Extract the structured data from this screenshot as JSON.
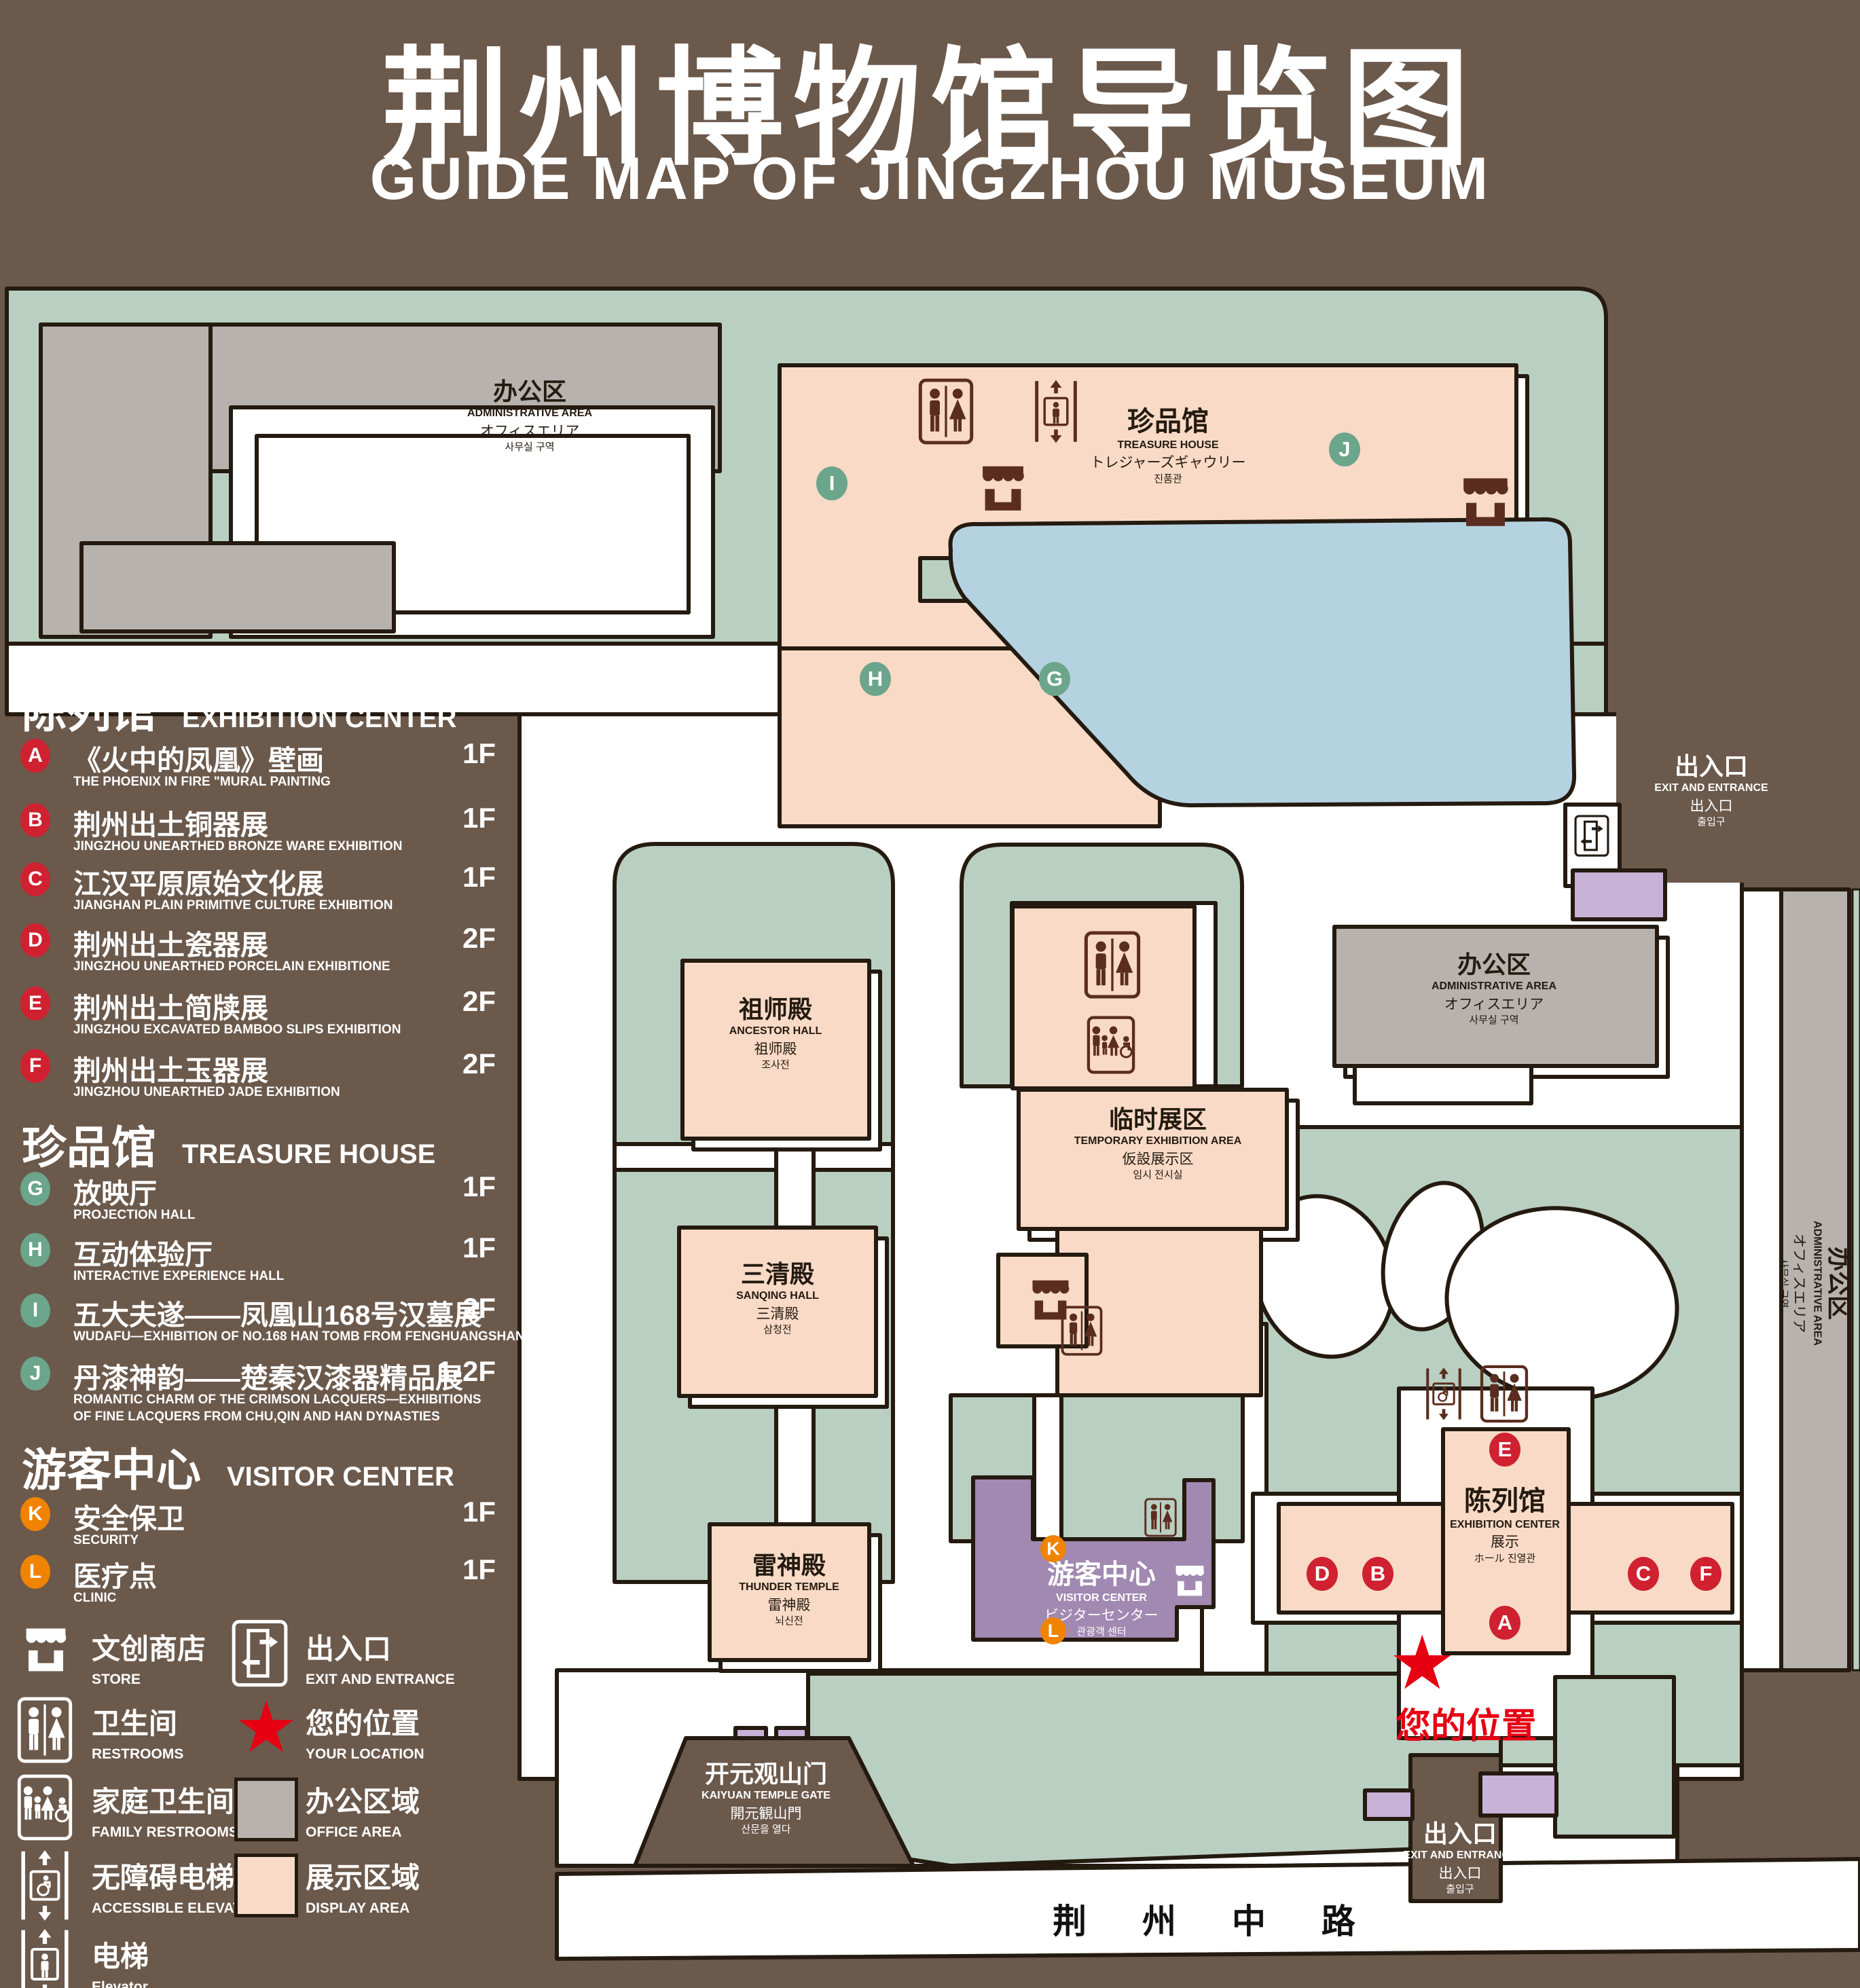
{
  "title": {
    "zh": "荆州博物馆导览图",
    "en": "GUIDE MAP OF JINGZHOU MUSEUM"
  },
  "legend": {
    "sections": [
      {
        "zh": "陈列馆",
        "en": "EXHIBITION CENTER",
        "badge_color": "#cf2130",
        "items": [
          {
            "letter": "A",
            "zh": "《火中的凤凰》壁画",
            "en": "THE PHOENIX IN FIRE \"MURAL PAINTING",
            "floor": "1F"
          },
          {
            "letter": "B",
            "zh": "荆州出土铜器展",
            "en": "JINGZHOU UNEARTHED BRONZE WARE EXHIBITION",
            "floor": "1F"
          },
          {
            "letter": "C",
            "zh": "江汉平原原始文化展",
            "en": "JIANGHAN PLAIN PRIMITIVE CULTURE EXHIBITION",
            "floor": "1F"
          },
          {
            "letter": "D",
            "zh": "荆州出土瓷器展",
            "en": "JINGZHOU UNEARTHED PORCELAIN EXHIBITIONE",
            "floor": "2F"
          },
          {
            "letter": "E",
            "zh": "荆州出土简牍展",
            "en": "JINGZHOU EXCAVATED BAMBOO SLIPS EXHIBITION",
            "floor": "2F"
          },
          {
            "letter": "F",
            "zh": "荆州出土玉器展",
            "en": "JINGZHOU UNEARTHED JADE EXHIBITION",
            "floor": "2F"
          }
        ]
      },
      {
        "zh": "珍品馆",
        "en": "TREASURE HOUSE",
        "badge_color": "#6ba58b",
        "items": [
          {
            "letter": "G",
            "zh": "放映厅",
            "en": "PROJECTION HALL",
            "floor": "1F"
          },
          {
            "letter": "H",
            "zh": "互动体验厅",
            "en": "INTERACTIVE EXPERIENCE HALL",
            "floor": "1F"
          },
          {
            "letter": "I",
            "zh": "五大夫遂——凤凰山168号汉墓展",
            "en": "WUDAFU—EXHIBITION OF NO.168 HAN TOMB FROM FENGHUANGSHAN",
            "floor": "2F"
          },
          {
            "letter": "J",
            "zh": "丹漆神韵——楚秦汉漆器精品展",
            "en": "ROMANTIC CHARM OF THE CRIMSON LACQUERS—EXHIBITIONS",
            "en2": "OF FINE LACQUERS FROM CHU,QIN AND HAN DYNASTIES",
            "floor": "1-2F"
          }
        ]
      },
      {
        "zh": "游客中心",
        "en": "VISITOR CENTER",
        "badge_color": "#f08300",
        "items": [
          {
            "letter": "K",
            "zh": "安全保卫",
            "en": "SECURITY",
            "floor": "1F"
          },
          {
            "letter": "L",
            "zh": "医疗点",
            "en": "CLINIC",
            "floor": "1F"
          }
        ]
      }
    ],
    "symbols": {
      "store": {
        "zh": "文创商店",
        "en": "STORE",
        "icon": "store-icon"
      },
      "restrooms": {
        "zh": "卫生间",
        "en": "RESTROOMS",
        "icon": "restrooms-icon"
      },
      "family_restrooms": {
        "zh": "家庭卫生间",
        "en": "FAMILY RESTROOMS",
        "icon": "family-restrooms-icon"
      },
      "accessible_elevator": {
        "zh": "无障碍电梯",
        "en": "ACCESSIBLE ELEVATOR",
        "icon": "accessible-elevator-icon"
      },
      "elevator": {
        "zh": "电梯",
        "en": "Elevator",
        "icon": "elevator-icon"
      },
      "exit": {
        "zh": "出入口",
        "en": "EXIT AND ENTRANCE",
        "icon": "exit-entrance-icon"
      },
      "your_location": {
        "zh": "您的位置",
        "en": "YOUR LOCATION",
        "icon": "location-star-icon",
        "color": "#e60012"
      },
      "office_area": {
        "zh": "办公区域",
        "en": "OFFICE AREA",
        "color": "#b7b2ae"
      },
      "display_area": {
        "zh": "展示区域",
        "en": "DISPLAY AREA",
        "color": "#f8dac6"
      }
    }
  },
  "map": {
    "labels": {
      "admin_top": {
        "l1": "办公区",
        "l2": "ADMINISTRATIVE AREA",
        "l3": "オフィスエリア",
        "l4": "사무실 구역"
      },
      "admin_mid": {
        "l1": "办公区",
        "l2": "ADMINISTRATIVE AREA",
        "l3": "オフィスエリア",
        "l4": "사무실 구역"
      },
      "admin_right": {
        "l1": "办公区",
        "l2": "ADMINISTRATIVE AREA",
        "l3": "オフィスエリア",
        "l4": "사무실 구역"
      },
      "treasure_house": {
        "l1": "珍品馆",
        "l2": "TREASURE HOUSE",
        "l3": "トレジャーズギャウリー",
        "l4": "진품관"
      },
      "ancestor_hall": {
        "l1": "祖师殿",
        "l2": "ANCESTOR HALL",
        "l3": "祖师殿",
        "l4": "조사전"
      },
      "sanqing_hall": {
        "l1": "三清殿",
        "l2": "SANQING HALL",
        "l3": "三清殿",
        "l4": "삼청전"
      },
      "thunder_temple": {
        "l1": "雷神殿",
        "l2": "THUNDER TEMPLE",
        "l3": "雷神殿",
        "l4": "뇌신전"
      },
      "temporary_area": {
        "l1": "临时展区",
        "l2": "TEMPORARY EXHIBITION AREA",
        "l3": "仮設展示区",
        "l4": "임시 전시실"
      },
      "visitor_center": {
        "l1": "游客中心",
        "l2": "VISITOR CENTER",
        "l3": "ビジターセンター",
        "l4": "관광객 센터"
      },
      "exhibition_center": {
        "l1": "陈列馆",
        "l2": "EXHIBITION CENTER",
        "l3": "展示",
        "l4": "ホール 진열관"
      },
      "gate": {
        "l1": "开元观山门",
        "l2": "KAIYUAN TEMPLE GATE",
        "l3": "開元観山門",
        "l4": "산문을 열다"
      },
      "exit_ne": {
        "l1": "出入口",
        "l2": "EXIT AND ENTRANCE",
        "l3": "出入口",
        "l4": "출입구"
      },
      "exit_s": {
        "l1": "出入口",
        "l2": "EXIT AND ENTRANCE",
        "l3": "出入口",
        "l4": "출입구"
      },
      "road": "荆 州 中 路",
      "your_location": "您的位置"
    },
    "markers": [
      {
        "letter": "I",
        "color": "green"
      },
      {
        "letter": "J",
        "color": "green"
      },
      {
        "letter": "H",
        "color": "green"
      },
      {
        "letter": "G",
        "color": "green"
      },
      {
        "letter": "E",
        "color": "red"
      },
      {
        "letter": "D",
        "color": "red"
      },
      {
        "letter": "B",
        "color": "red"
      },
      {
        "letter": "C",
        "color": "red"
      },
      {
        "letter": "F",
        "color": "red"
      },
      {
        "letter": "A",
        "color": "red"
      },
      {
        "letter": "K",
        "color": "orange"
      },
      {
        "letter": "L",
        "color": "orange"
      }
    ],
    "area_colors": {
      "green_space": "#b9cfc1",
      "display": "#f8dac6",
      "office": "#b7b2ae",
      "visitor": "#a189b2",
      "gate_block": "#c9b2d8",
      "water": "#b5d2e0",
      "path": "#ffffff"
    }
  }
}
